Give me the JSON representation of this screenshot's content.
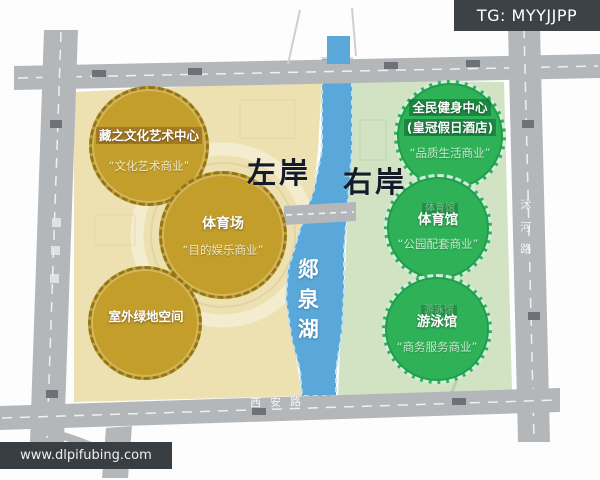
{
  "watermarks": {
    "tg_badge": "TG: MYYJJPP",
    "site": "www.dlpifubing.com"
  },
  "banks": {
    "left_label": "左岸",
    "right_label": "右岸"
  },
  "lake": {
    "name": "郯泉湖"
  },
  "roads": {
    "bottom_label": "西安路",
    "right_label": "沭河路"
  },
  "zones": {
    "left": {
      "fill": "#ede1b2",
      "circle_color": "#c49e2b",
      "circles": [
        {
          "id": "culture-center",
          "title": "藏之文化艺术中心",
          "subtitle": "“文化艺术商业”"
        },
        {
          "id": "stadium",
          "title": "体育场",
          "subtitle": "“目的娱乐商业”"
        },
        {
          "id": "green-space",
          "title": "室外绿地空间",
          "subtitle": ""
        }
      ]
    },
    "right": {
      "fill": "#d1e3c3",
      "circle_color": "#2fb257",
      "circles": [
        {
          "id": "fitness-center",
          "title": "全民健身中心",
          "title2": "(皇冠假日酒店)",
          "subtitle": "“品质生活商业”"
        },
        {
          "id": "gymnasium",
          "title": "体育馆",
          "faint_tag": "体育馆",
          "subtitle": "“公园配套商业”"
        },
        {
          "id": "natatorium",
          "title": "游泳馆",
          "faint_tag": "游泳馆",
          "subtitle": "“商务服务商业”"
        }
      ]
    }
  },
  "colors": {
    "lake_blue": "#5aa8d9",
    "road_gray": "#b4b7ba",
    "gold": "#c49e2b",
    "green": "#2fb257",
    "left_parcel": "#ede1b2",
    "right_parcel": "#d1e3c3",
    "watermark_bar": "#3d4247"
  }
}
